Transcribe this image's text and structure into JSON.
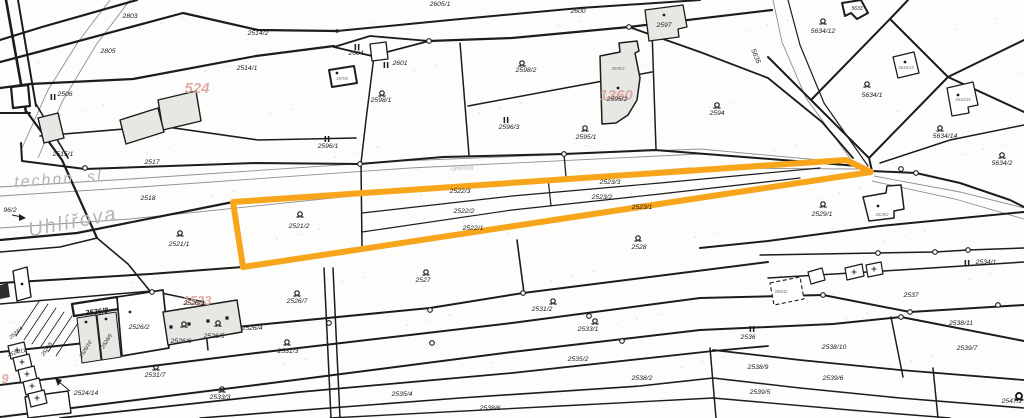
{
  "map": {
    "width": 1024,
    "height": 418,
    "colors": {
      "line": "#1c1c1c",
      "road": "#8f8f8f",
      "street_text": "#b4b4b4",
      "highlight": "#F7A61B",
      "pink": "#dca49e",
      "building_gray": "#e7e7e4",
      "building_white": "#ffffff",
      "tiny_text": "#6b6b6b"
    },
    "streets": [
      {
        "text": "technn. sl.",
        "x": 62,
        "y": 184,
        "size": 16,
        "rot": -4
      },
      {
        "text": "Uhlířova",
        "x": 74,
        "y": 228,
        "size": 20,
        "rot": -11
      },
      {
        "text": "Uhlířova",
        "x": 462,
        "y": 170,
        "size": 6,
        "rot": -3
      }
    ],
    "pink_labels": [
      {
        "text": "524",
        "x": 197,
        "y": 93,
        "size": 15
      },
      {
        "text": "1360",
        "x": 616,
        "y": 100,
        "size": 15
      },
      {
        "text": "1533",
        "x": 197,
        "y": 305,
        "size": 13
      },
      {
        "text": "9",
        "x": 5,
        "y": 383,
        "size": 13
      }
    ],
    "labels": [
      {
        "t": "2803",
        "x": 130,
        "y": 18
      },
      {
        "t": "2805",
        "x": 108,
        "y": 53
      },
      {
        "t": "2506",
        "x": 65,
        "y": 96
      },
      {
        "t": "2514/2",
        "x": 258,
        "y": 35
      },
      {
        "t": "2514/1",
        "x": 247,
        "y": 70
      },
      {
        "t": "2515/1",
        "x": 63,
        "y": 156
      },
      {
        "t": "2517",
        "x": 152,
        "y": 164
      },
      {
        "t": "2518",
        "x": 148,
        "y": 200
      },
      {
        "t": "96/2",
        "x": 10,
        "y": 212
      },
      {
        "t": "2604",
        "x": 356,
        "y": 55
      },
      {
        "t": "2601",
        "x": 400,
        "y": 65
      },
      {
        "t": "2605/1",
        "x": 440,
        "y": 6
      },
      {
        "t": "2600",
        "x": 578,
        "y": 13
      },
      {
        "t": "2597",
        "x": 664,
        "y": 27
      },
      {
        "t": "2598/1",
        "x": 381,
        "y": 102
      },
      {
        "t": "2598/2",
        "x": 526,
        "y": 72
      },
      {
        "t": "2596/1",
        "x": 328,
        "y": 148
      },
      {
        "t": "2596/3",
        "x": 509,
        "y": 129
      },
      {
        "t": "2595/1",
        "x": 586,
        "y": 139
      },
      {
        "t": "2595/2",
        "x": 617,
        "y": 101
      },
      {
        "t": "2594",
        "x": 717,
        "y": 115
      },
      {
        "t": "5635",
        "x": 754,
        "y": 57,
        "rot": 68
      },
      {
        "t": "5633",
        "x": 857,
        "y": 10,
        "size": 5
      },
      {
        "t": "5634/12",
        "x": 823,
        "y": 33
      },
      {
        "t": "5634/1",
        "x": 872,
        "y": 97
      },
      {
        "t": "5634/14",
        "x": 945,
        "y": 138
      },
      {
        "t": "5634/2",
        "x": 1002,
        "y": 165
      },
      {
        "t": "2521/1",
        "x": 179,
        "y": 246
      },
      {
        "t": "2521/2",
        "x": 299,
        "y": 228
      },
      {
        "t": "2522/3",
        "x": 460,
        "y": 193
      },
      {
        "t": "2522/2",
        "x": 464,
        "y": 213
      },
      {
        "t": "2522/1",
        "x": 473,
        "y": 230
      },
      {
        "t": "2523/3",
        "x": 610,
        "y": 184
      },
      {
        "t": "2523/2",
        "x": 602,
        "y": 199
      },
      {
        "t": "2523/1",
        "x": 642,
        "y": 209
      },
      {
        "t": "2528",
        "x": 639,
        "y": 249
      },
      {
        "t": "2527",
        "x": 423,
        "y": 282
      },
      {
        "t": "2529/1",
        "x": 822,
        "y": 216
      },
      {
        "t": "2534/1",
        "x": 986,
        "y": 264
      },
      {
        "t": "2526/7",
        "x": 297,
        "y": 303
      },
      {
        "t": "2526/8",
        "x": 97,
        "y": 314,
        "bold": true,
        "rot": -7
      },
      {
        "t": "2526/2",
        "x": 139,
        "y": 329
      },
      {
        "t": "2526/3",
        "x": 194,
        "y": 305
      },
      {
        "t": "2526/6",
        "x": 181,
        "y": 343
      },
      {
        "t": "2526/5",
        "x": 214,
        "y": 338
      },
      {
        "t": "2526/4",
        "x": 252,
        "y": 330
      },
      {
        "t": "2526/10",
        "x": 87,
        "y": 350,
        "rot": -58,
        "size": 5.2
      },
      {
        "t": "2526/9",
        "x": 108,
        "y": 342,
        "rot": -58,
        "size": 5.2
      },
      {
        "t": "2524/4",
        "x": 17,
        "y": 334,
        "rot": -40,
        "size": 5.2
      },
      {
        "t": "2524/5",
        "x": 48,
        "y": 350,
        "rot": -55,
        "size": 5.2
      },
      {
        "t": "2524/11",
        "x": 17,
        "y": 354,
        "rot": -15,
        "size": 5.2
      },
      {
        "t": "2524/14",
        "x": 86,
        "y": 395
      },
      {
        "t": "2531/7",
        "x": 155,
        "y": 377
      },
      {
        "t": "2533/3",
        "x": 220,
        "y": 399
      },
      {
        "t": "2531/3",
        "x": 288,
        "y": 353
      },
      {
        "t": "2531/2",
        "x": 542,
        "y": 311
      },
      {
        "t": "2533/1",
        "x": 588,
        "y": 331
      },
      {
        "t": "2535/2",
        "x": 578,
        "y": 361
      },
      {
        "t": "2535/4",
        "x": 402,
        "y": 396
      },
      {
        "t": "2538/6",
        "x": 490,
        "y": 410
      },
      {
        "t": "2538/2",
        "x": 642,
        "y": 380
      },
      {
        "t": "2536",
        "x": 748,
        "y": 339
      },
      {
        "t": "2537",
        "x": 911,
        "y": 297
      },
      {
        "t": "2538/11",
        "x": 961,
        "y": 325
      },
      {
        "t": "2538/10",
        "x": 834,
        "y": 349
      },
      {
        "t": "2539/7",
        "x": 967,
        "y": 350
      },
      {
        "t": "2539/6",
        "x": 833,
        "y": 380
      },
      {
        "t": "2538/9",
        "x": 758,
        "y": 369
      },
      {
        "t": "2539/5",
        "x": 760,
        "y": 394
      },
      {
        "t": "2547/2",
        "x": 1012,
        "y": 403
      }
    ],
    "tiny_labels": [
      {
        "t": "19705",
        "x": 342,
        "y": 80
      },
      {
        "t": "2595/3",
        "x": 618,
        "y": 70
      },
      {
        "t": "5634/13",
        "x": 906,
        "y": 69
      },
      {
        "t": "5634/15",
        "x": 963,
        "y": 101
      },
      {
        "t": "2529/2",
        "x": 882,
        "y": 216
      },
      {
        "t": "280/42",
        "x": 781,
        "y": 293
      }
    ],
    "markers_q": [
      [
        180,
        233
      ],
      [
        300,
        214
      ],
      [
        426,
        272
      ],
      [
        638,
        238
      ],
      [
        297,
        293
      ],
      [
        382,
        93
      ],
      [
        522,
        63
      ],
      [
        585,
        128
      ],
      [
        717,
        105
      ],
      [
        823,
        21
      ],
      [
        867,
        84
      ],
      [
        940,
        128
      ],
      [
        1002,
        155
      ],
      [
        823,
        204
      ],
      [
        156,
        367
      ],
      [
        222,
        389
      ],
      [
        287,
        342
      ],
      [
        553,
        301
      ],
      [
        595,
        321
      ],
      [
        184,
        324
      ],
      [
        218,
        323
      ]
    ],
    "markers_q_bold": [
      [
        1019,
        396
      ]
    ],
    "markers_ii": [
      [
        53,
        97
      ],
      [
        357,
        47
      ],
      [
        386,
        65
      ],
      [
        327,
        139
      ],
      [
        506,
        120
      ],
      [
        967,
        263
      ],
      [
        752,
        329
      ]
    ],
    "lines": [
      {
        "p": "137,0 42,27 0,40",
        "w": 2.2
      },
      {
        "p": "0,62 38,52 183,13 258,30 337,31",
        "w": 2.2
      },
      {
        "p": "0,88 30,84 133,79 256,56 334,46",
        "w": 2.2
      },
      {
        "p": "337,31 450,20 580,8 700,0",
        "w": 2
      },
      {
        "p": "334,47 370,36 429,41",
        "w": 1.8
      },
      {
        "p": "334,47 372,56 429,41",
        "w": 1.8
      },
      {
        "p": "429,41 512,38 629,27 772,10",
        "w": 2.2
      },
      {
        "p": "629,27 700,52 768,78 822,122 853,158",
        "w": 1.8
      },
      {
        "p": "21,143 22,161 85,169 256,163 360,164 443,157 564,154 655,150 858,166",
        "w": 2
      },
      {
        "p": "0,240 77,233 233,202",
        "w": 2.2
      },
      {
        "p": "6,0 26,112",
        "w": 2.6
      },
      {
        "p": "18,0 36,106",
        "w": 2
      },
      {
        "p": "0,113 30,113",
        "w": 2
      },
      {
        "p": "27,112 62,160 97,238",
        "w": 2.2
      },
      {
        "p": "36,104 68,158",
        "w": 1.6
      },
      {
        "p": "40,136 160,126 258,140 356,138",
        "w": 1.6
      },
      {
        "p": "0,252 60,247 97,238",
        "w": 1.6
      },
      {
        "p": "97,238 128,264 150,291",
        "w": 1.6
      },
      {
        "p": "0,283 150,274 243,267",
        "w": 2
      },
      {
        "p": "0,304 152,291 204,302",
        "w": 1.5
      },
      {
        "p": "0,352 256,325 430,308 523,293 768,262",
        "w": 2
      },
      {
        "p": "0,385 256,353 512,323 700,298 823,295 910,312 1024,305",
        "w": 2
      },
      {
        "p": "0,417 256,385 512,352 700,330 833,324 901,317 1024,341",
        "w": 2
      },
      {
        "p": "60,418 300,392 512,373 713,351 768,346",
        "w": 1.8
      },
      {
        "p": "713,350 800,360 900,370 1024,380",
        "w": 1.8
      },
      {
        "p": "200,418 460,398 640,386 713,378",
        "w": 1.6
      },
      {
        "p": "713,378 800,388 900,398 1024,408",
        "w": 1.6
      },
      {
        "p": "330,418 560,406 713,398",
        "w": 1.4
      },
      {
        "p": "713,398 850,410 950,418",
        "w": 1.4
      },
      {
        "p": "374,56 366,120 361,163 362,248",
        "w": 1.5
      },
      {
        "p": "460,43 469,155",
        "w": 1.5
      },
      {
        "p": "652,30 656,149",
        "w": 1.5
      },
      {
        "p": "468,106 565,88 652,72",
        "w": 1.5
      },
      {
        "p": "564,154 566,177",
        "w": 1.3
      },
      {
        "p": "362,213 512,196 660,183 820,168",
        "w": 1.2
      },
      {
        "p": "362,232 512,210 660,194 800,178",
        "w": 1.2
      },
      {
        "p": "548,178 551,206",
        "w": 1.2
      },
      {
        "p": "517,240 524,293",
        "w": 1.6
      },
      {
        "p": "324,268 331,418",
        "w": 1.5
      },
      {
        "p": "333,268 340,418",
        "w": 1.5
      },
      {
        "p": "203,303 208,350",
        "w": 1.5
      },
      {
        "p": "710,348 716,418",
        "w": 1.5
      },
      {
        "p": "891,317 903,377",
        "w": 1.5
      },
      {
        "p": "933,368 938,418",
        "w": 1.5
      },
      {
        "p": "788,0 800,45 824,103 868,166",
        "w": 1.2
      },
      {
        "p": "872,171 916,173 960,183 1010,200 1024,207",
        "w": 2
      },
      {
        "p": "700,248 768,241 880,226 1024,212",
        "w": 2
      },
      {
        "p": "760,255 878,253 935,252 968,250 1024,248",
        "w": 1.5
      },
      {
        "p": "768,278 900,270 1024,262",
        "w": 1.5
      },
      {
        "p": "811,100 890,19 948,77 869,158 811,100",
        "w": 2
      },
      {
        "p": "948,77 1024,40",
        "w": 2
      },
      {
        "p": "948,77 1024,112",
        "w": 2
      },
      {
        "p": "890,19 908,0",
        "w": 2
      },
      {
        "p": "768,57 811,100",
        "w": 2
      },
      {
        "p": "869,158 872,171",
        "w": 2
      },
      {
        "p": "880,163 950,140 1024,125",
        "w": 1.5
      },
      {
        "p": "182,309 186,341",
        "w": 1.1
      },
      {
        "p": "200,306 205,338",
        "w": 1.1
      },
      {
        "p": "219,303 224,335",
        "w": 1.1
      },
      {
        "p": "40,300 16,336",
        "w": 0.8
      },
      {
        "p": "48,304 24,340",
        "w": 0.8
      },
      {
        "p": "56,308 32,344",
        "w": 0.8
      },
      {
        "p": "64,312 40,348",
        "w": 0.8
      },
      {
        "p": "72,316 48,352",
        "w": 0.8
      },
      {
        "p": "80,320 56,356",
        "w": 0.8
      }
    ],
    "gray_lines": [
      {
        "p": "0,187 130,179 400,161 700,149 852,163"
      },
      {
        "p": "0,196 140,187 410,168 700,154 855,166"
      },
      {
        "p": "0,228 130,219 400,191 690,168 858,169"
      },
      {
        "p": "110,0 78,42 48,90 22,148"
      },
      {
        "p": "130,0 96,45 62,102 38,158"
      },
      {
        "p": "773,0 782,42 806,98 852,161"
      },
      {
        "p": "874,176 960,192 1024,208"
      },
      {
        "p": "872,181 955,199 1024,219"
      }
    ],
    "buildings": [
      {
        "p": "158,100 196,91 201,121 163,130",
        "fill": "g",
        "w": 1.4
      },
      {
        "p": "120,120 158,108 164,132 126,144",
        "fill": "g",
        "w": 1.4
      },
      {
        "p": "38,118 58,113 64,138 44,143",
        "fill": "g",
        "w": 1.4
      },
      {
        "p": "329,70 354,66 357,83 332,87",
        "fill": "w",
        "w": 2,
        "dot": [
          337,
          73
        ]
      },
      {
        "p": "370,44 386,42 388,59 372,61",
        "fill": "w",
        "w": 1.3
      },
      {
        "p": "645,10 683,5 687,27 678,29 679,37 649,41",
        "fill": "g",
        "w": 1.3,
        "dot": [
          664,
          15
        ]
      },
      {
        "p": "600,56 620,52 619,43 637,41 639,51 635,53 640,78 637,100 628,115 616,123 602,124",
        "fill": "g",
        "w": 1.5,
        "dot": [
          618,
          88
        ]
      },
      {
        "p": "842,3 861,0 868,13 857,19 851,13 845,16",
        "fill": "w",
        "w": 2
      },
      {
        "p": "893,57 914,52 919,73 898,78",
        "fill": "w",
        "w": 1.3,
        "dot": [
          905,
          62
        ]
      },
      {
        "p": "947,88 973,82 978,105 968,107 969,113 952,116",
        "fill": "w",
        "w": 1.3,
        "dot": [
          958,
          95
        ]
      },
      {
        "p": "863,197 886,193 887,186 901,185 904,209 894,211 894,218 869,221",
        "fill": "w",
        "w": 1.5,
        "dot": [
          878,
          206
        ]
      },
      {
        "p": "845,268 862,264 864,276 847,280",
        "fill": "w",
        "w": 1.2,
        "plus": [
          854,
          272
        ]
      },
      {
        "p": "866,265 881,262 883,274 868,277",
        "fill": "w",
        "w": 1.2,
        "plus": [
          874,
          269
        ]
      },
      {
        "p": "808,272 822,268 825,280 811,284",
        "fill": "w",
        "w": 1.2
      },
      {
        "p": "770,283 800,277 804,299 774,305",
        "fill": "w",
        "w": 1.1,
        "dash": true
      },
      {
        "p": "13,271 27,267 31,297 17,301",
        "fill": "w",
        "w": 1.4,
        "dot": [
          22,
          284
        ]
      },
      {
        "p": "25,397 68,391 71,413 28,418",
        "fill": "w",
        "w": 1.4
      },
      {
        "p": "11,87 28,85 30,106 13,108",
        "fill": "w",
        "w": 2.2
      },
      {
        "p": "72,304 117,297 119,309 74,316",
        "fill": "w",
        "w": 2.3
      },
      {
        "p": "77,318 96,315 101,360 82,363",
        "fill": "g",
        "w": 1.1,
        "dot": [
          86,
          322
        ]
      },
      {
        "p": "97,315 116,312 121,357 102,360",
        "fill": "g",
        "w": 1.1,
        "dot": [
          106,
          319
        ]
      },
      {
        "p": "117,297 163,290 169,348 122,356",
        "fill": "w",
        "w": 1.7,
        "dot": [
          130,
          312
        ]
      },
      {
        "p": "163,312 237,300 242,332 168,345",
        "fill": "g",
        "w": 1.4
      },
      {
        "p": "8,346 24,342 27,355 11,359",
        "fill": "w",
        "w": 1.3,
        "plus": [
          17,
          350
        ]
      },
      {
        "p": "13,358 29,354 32,367 16,371",
        "fill": "w",
        "w": 1.3,
        "plus": [
          22,
          362
        ]
      },
      {
        "p": "18,370 34,366 37,379 21,383",
        "fill": "w",
        "w": 1.3,
        "plus": [
          27,
          374
        ]
      },
      {
        "p": "23,382 39,378 42,391 26,395",
        "fill": "w",
        "w": 1.3,
        "plus": [
          32,
          386
        ]
      },
      {
        "p": "28,394 44,390 47,403 31,407",
        "fill": "w",
        "w": 1.3,
        "plus": [
          37,
          398
        ]
      }
    ],
    "dark_shapes": [
      {
        "p": "0,285 8,283 10,297 0,299"
      }
    ],
    "small_squares": [
      [
        171,
        327
      ],
      [
        189,
        324
      ],
      [
        208,
        321
      ],
      [
        227,
        318
      ]
    ],
    "nodes": [
      [
        85,
        168
      ],
      [
        360,
        164
      ],
      [
        564,
        154
      ],
      [
        629,
        27
      ],
      [
        429,
        41
      ],
      [
        878,
        253
      ],
      [
        935,
        252
      ],
      [
        968,
        250
      ],
      [
        823,
        295
      ],
      [
        910,
        312
      ],
      [
        998,
        305
      ],
      [
        589,
        316
      ],
      [
        329,
        323
      ],
      [
        430,
        310
      ],
      [
        523,
        293
      ],
      [
        152,
        292
      ],
      [
        432,
        343
      ],
      [
        622,
        341
      ],
      [
        916,
        173
      ],
      [
        901,
        169
      ],
      [
        901,
        317
      ]
    ],
    "filled_dots": [
      [
        337,
        31
      ]
    ],
    "arrows": [
      {
        "line": "12,215 22,217",
        "head": "26,218 19,214 19,221"
      },
      {
        "line": "70,391 58,381",
        "head": "55,378 62,380 58,386"
      }
    ],
    "highlight": {
      "points": "233,202 846,160 871,172 243,267",
      "stroke_width": 6
    }
  }
}
